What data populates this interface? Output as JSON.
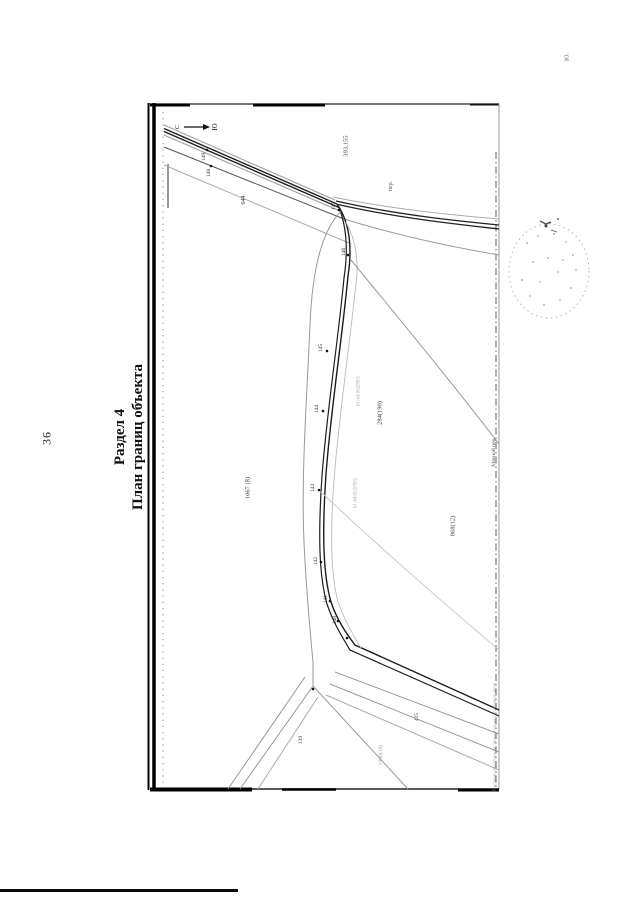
{
  "page": {
    "number": "36",
    "corner_mark": "Ю.",
    "title": {
      "line1": "Раздел 4",
      "line2": "План границ объекта"
    }
  },
  "plan": {
    "north_point": "С",
    "south_point": "Ю",
    "legend_note": "Условные обозначения приведены на следующем листе",
    "point_labels": [
      {
        "t": "149",
        "x": 204,
        "y": 157
      },
      {
        "t": "148",
        "x": 209,
        "y": 173
      },
      {
        "t": "147",
        "x": 334,
        "y": 206
      },
      {
        "t": "146",
        "x": 344,
        "y": 252
      },
      {
        "t": "145",
        "x": 321,
        "y": 348
      },
      {
        "t": "144",
        "x": 317,
        "y": 409
      },
      {
        "t": "143",
        "x": 313,
        "y": 488
      },
      {
        "t": "142",
        "x": 316,
        "y": 561
      },
      {
        "t": "141",
        "x": 326,
        "y": 599
      },
      {
        "t": "140",
        "x": 335,
        "y": 620
      }
    ],
    "area_labels": [
      {
        "t": "393.155",
        "x": 346,
        "y": 146,
        "s": 6.5,
        "c": "#444444"
      },
      {
        "t": "пер.",
        "x": 391,
        "y": 186,
        "s": 6,
        "c": "#555555"
      },
      {
        "t": "644",
        "x": 244,
        "y": 200,
        "s": 6,
        "c": "#333333"
      },
      {
        "t": "61:44:0020901",
        "x": 359,
        "y": 391,
        "s": 5,
        "c": "#aaaaaa"
      },
      {
        "t": "284(190)",
        "x": 380,
        "y": 413,
        "s": 6.5,
        "c": "#333333"
      },
      {
        "t": "1067 (8)",
        "x": 248,
        "y": 488,
        "s": 6.5,
        "c": "#333333"
      },
      {
        "t": "61:44:0020902",
        "x": 356,
        "y": 493,
        "s": 5,
        "c": "#aaaaaa"
      },
      {
        "t": "868(12)",
        "x": 453,
        "y": 526,
        "s": 6.5,
        "c": "#444444"
      },
      {
        "t": "Мясной пер.",
        "x": 494,
        "y": 452,
        "s": 5.5,
        "c": "#555555"
      },
      {
        "t": "415",
        "x": 417,
        "y": 717,
        "s": 5.5,
        "c": "#333333"
      },
      {
        "t": "139",
        "x": 301,
        "y": 740,
        "s": 5.5,
        "c": "#333333"
      },
      {
        "t": "1960(19)",
        "x": 381,
        "y": 755,
        "s": 5.5,
        "c": "#999999"
      }
    ]
  },
  "colors": {
    "paper": "#ffffff",
    "line_dark": "#1d1d1d",
    "line_gray": "#999999",
    "stamp": "#b5b5b5"
  }
}
